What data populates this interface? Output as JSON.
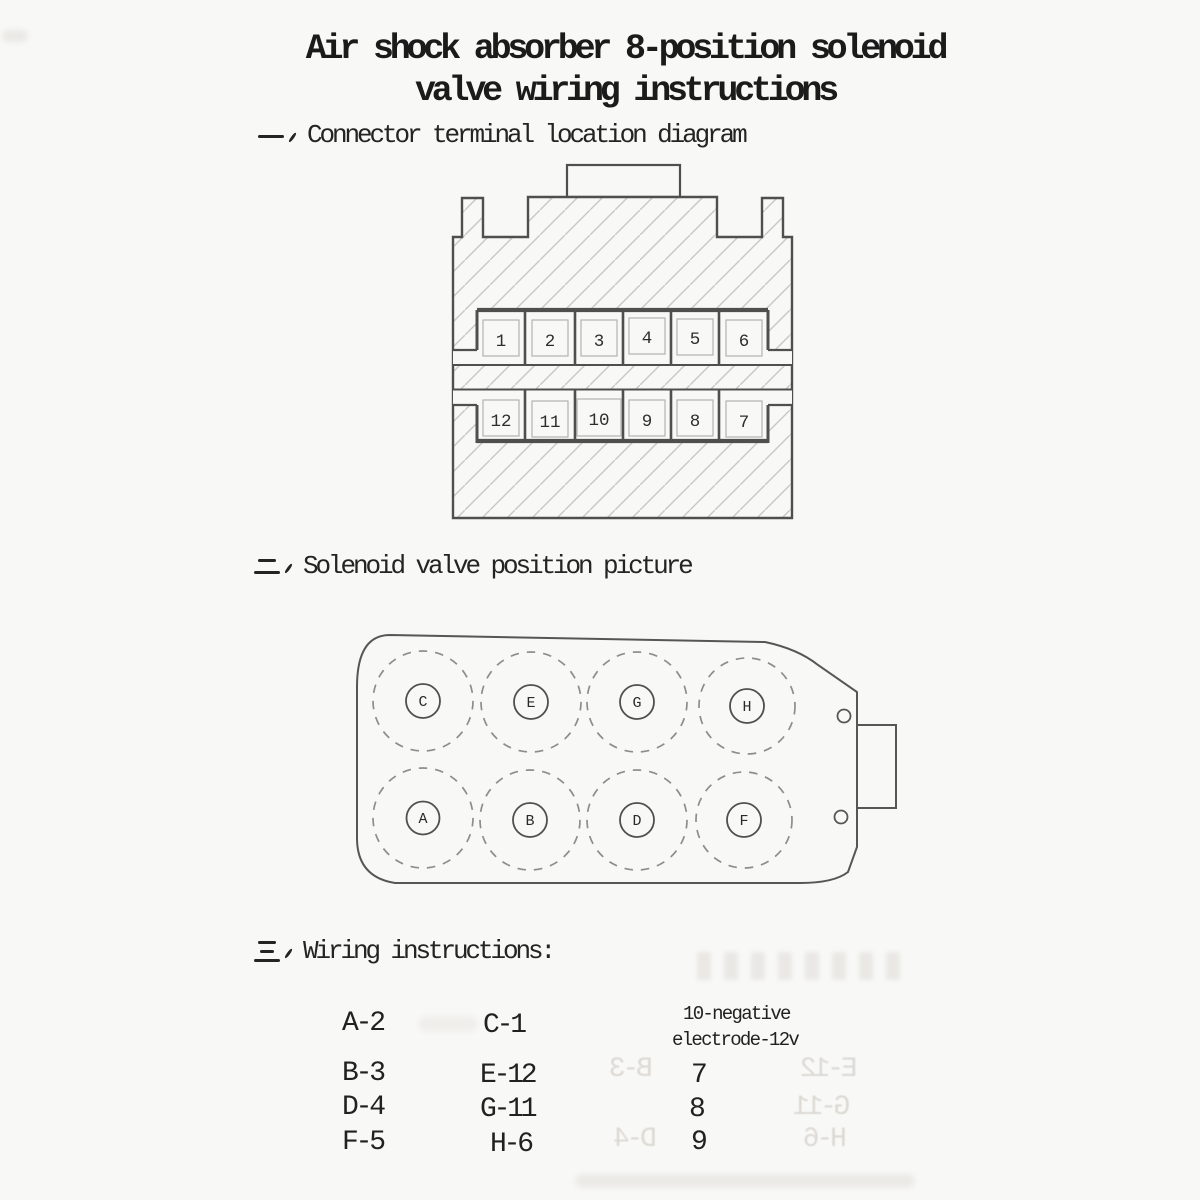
{
  "title": {
    "line1": "Air shock absorber 8-position solenoid",
    "line2": "valve wiring instructions"
  },
  "sections": {
    "one": {
      "marker": "一、",
      "label": "Connector terminal location diagram"
    },
    "two": {
      "marker": "二、",
      "label": "Solenoid valve position picture"
    },
    "three": {
      "marker": "三、",
      "label": "Wiring instructions:"
    }
  },
  "connector": {
    "top_row": [
      "1",
      "2",
      "3",
      "4",
      "5",
      "6"
    ],
    "bottom_row": [
      "12",
      "11",
      "10",
      "9",
      "8",
      "7"
    ]
  },
  "valve": {
    "top_row": [
      "C",
      "E",
      "G",
      "H"
    ],
    "bottom_row": [
      "A",
      "B",
      "D",
      "F"
    ]
  },
  "wiring": {
    "col1": [
      "A-2",
      "B-3",
      "D-4",
      "F-5"
    ],
    "col2": [
      "C-1",
      "E-12",
      "G-11",
      "H-6"
    ],
    "col3_header": [
      "10-negative",
      "electrode-12v"
    ],
    "col3": [
      "7",
      "8",
      "9"
    ]
  },
  "colors": {
    "paper": "#f8f8f6",
    "ink": "#1e1e1e",
    "diagram_line": "#4f4f4d",
    "hatch": "#c7c7c3",
    "dashed_circle": "#8d8d8b",
    "pin_outline": "#b3b3b0"
  }
}
